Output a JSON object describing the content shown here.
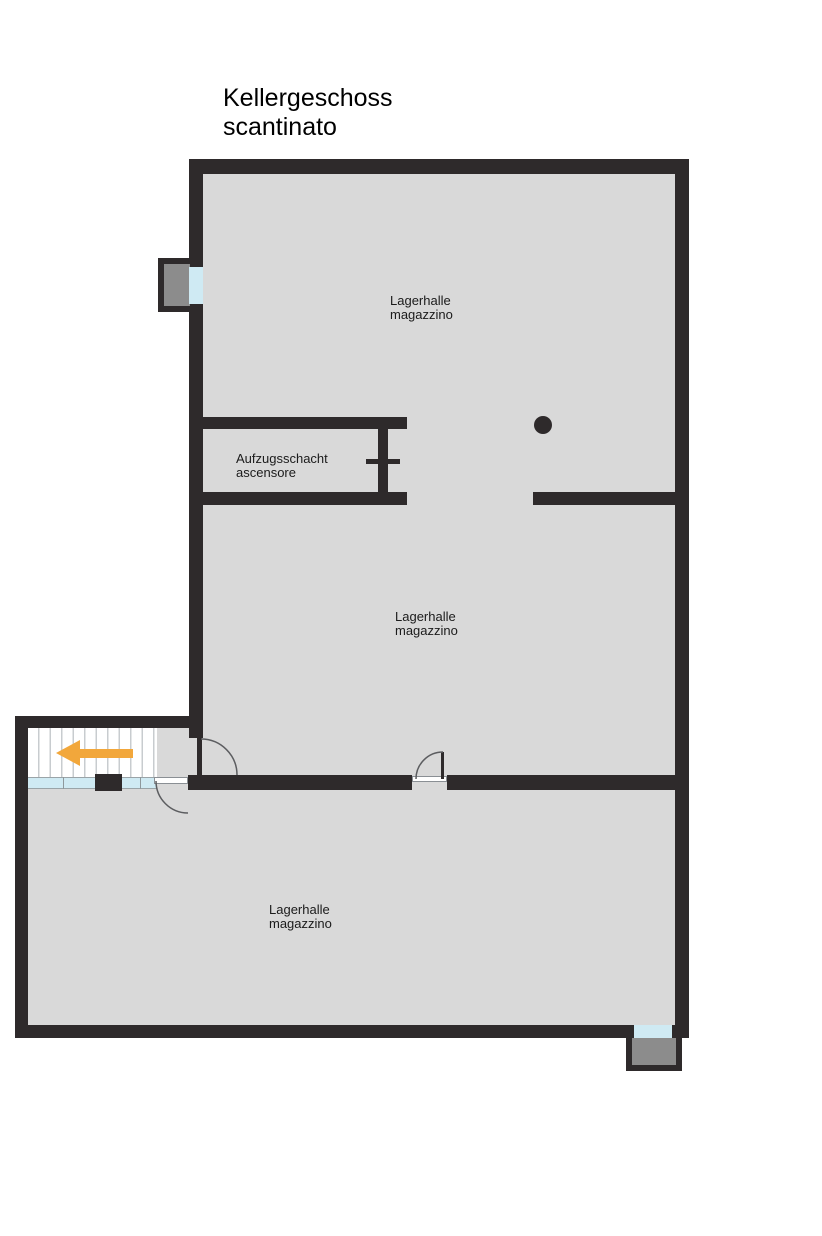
{
  "title": {
    "line1": "Kellergeschoss",
    "line2": "scantinato"
  },
  "rooms": {
    "upper": {
      "name_de": "Lagerhalle",
      "name_it": "magazzino"
    },
    "shaft": {
      "name_de": "Aufzugsschacht",
      "name_it": "ascensore"
    },
    "middle": {
      "name_de": "Lagerhalle",
      "name_it": "magazzino"
    },
    "lower": {
      "name_de": "Lagerhalle",
      "name_it": "magazzino"
    }
  },
  "symbols": {
    "direction_arrow": "stair-direction-arrow-left",
    "column": "structural-column-dot",
    "elevator_mark": "elevator-door-cross",
    "doors": "quarter-circle-swing",
    "windows": "glazed-opening-with-light-well"
  },
  "colors": {
    "wall": "#2e2a2b",
    "floor": "#d9d9d9",
    "glass": "#cfeaf3",
    "well": "#8c8c8c",
    "arrow": "#f2a73b",
    "arc": "#5c5d60",
    "stairline": "#c8cccf",
    "text": "#1b1b1b"
  }
}
